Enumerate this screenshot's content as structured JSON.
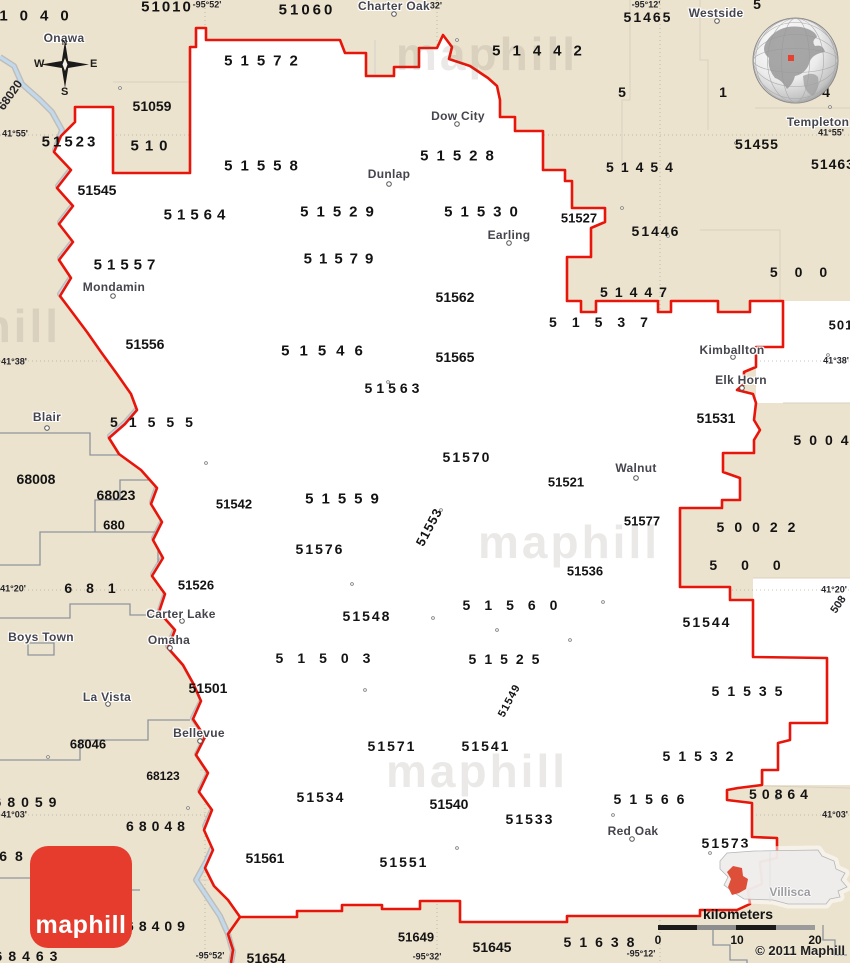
{
  "page": {
    "copyright": "© 2011 Maphill"
  },
  "logo": {
    "label": "maphill"
  },
  "compass": {
    "north": "N",
    "west": "W",
    "east": "E",
    "south": "S"
  },
  "scale_bar": {
    "title": "kilometers",
    "ticks": [
      "0",
      "10",
      "20"
    ]
  },
  "inset": {
    "label": "Villisca"
  },
  "map_colors": {
    "land": "#ece3cf",
    "region": "#ffffff",
    "boundary_red": "#e8150a",
    "river": "#bdd5ea",
    "logo_red": "#e53c2e",
    "inset_highlight": "#dd4f38"
  },
  "labels": {
    "zip_codes": [
      {
        "t": "1040",
        "x": 40,
        "y": 16,
        "s": 15,
        "w": 12
      },
      {
        "t": "51010",
        "x": 167,
        "y": 7,
        "s": 15,
        "w": 2
      },
      {
        "t": "51060",
        "x": 307,
        "y": 10,
        "s": 15,
        "w": 3
      },
      {
        "t": "51572",
        "x": 265,
        "y": 61,
        "s": 15,
        "w": 8
      },
      {
        "t": "51442",
        "x": 543,
        "y": 51,
        "s": 15,
        "w": 12
      },
      {
        "t": "51465",
        "x": 648,
        "y": 17,
        "s": 14,
        "w": 2
      },
      {
        "t": "5",
        "x": 757,
        "y": 4,
        "s": 14
      },
      {
        "t": "5",
        "x": 622,
        "y": 92,
        "s": 14
      },
      {
        "t": "1",
        "x": 723,
        "y": 92,
        "s": 14
      },
      {
        "t": "4",
        "x": 826,
        "y": 92,
        "s": 14
      },
      {
        "t": "51523",
        "x": 70,
        "y": 142,
        "s": 15,
        "w": 3
      },
      {
        "t": "51059",
        "x": 152,
        "y": 106,
        "s": 14
      },
      {
        "t": "510",
        "x": 152,
        "y": 146,
        "s": 15,
        "w": 6
      },
      {
        "t": "51545",
        "x": 97,
        "y": 190,
        "s": 14
      },
      {
        "t": "51558",
        "x": 265,
        "y": 166,
        "s": 15,
        "w": 8
      },
      {
        "t": "51528",
        "x": 461,
        "y": 156,
        "s": 15,
        "w": 8
      },
      {
        "t": "51454",
        "x": 643,
        "y": 167,
        "s": 14,
        "w": 7
      },
      {
        "t": "51455",
        "x": 757,
        "y": 144,
        "s": 14,
        "w": 1
      },
      {
        "t": "51463",
        "x": 833,
        "y": 164,
        "s": 14,
        "w": 1
      },
      {
        "t": "51564",
        "x": 197,
        "y": 215,
        "s": 15,
        "w": 5
      },
      {
        "t": "51529",
        "x": 341,
        "y": 212,
        "s": 15,
        "w": 8
      },
      {
        "t": "51530",
        "x": 485,
        "y": 212,
        "s": 15,
        "w": 8
      },
      {
        "t": "51527",
        "x": 579,
        "y": 218,
        "s": 13
      },
      {
        "t": "51446",
        "x": 656,
        "y": 231,
        "s": 14,
        "w": 2
      },
      {
        "t": "51557",
        "x": 127,
        "y": 265,
        "s": 15,
        "w": 5
      },
      {
        "t": "51579",
        "x": 342,
        "y": 259,
        "s": 15,
        "w": 7
      },
      {
        "t": "51562",
        "x": 455,
        "y": 297,
        "s": 14
      },
      {
        "t": "51447",
        "x": 637,
        "y": 292,
        "s": 14,
        "w": 7
      },
      {
        "t": "500",
        "x": 807,
        "y": 272,
        "s": 14,
        "w": 17
      },
      {
        "t": "51537",
        "x": 606,
        "y": 322,
        "s": 14,
        "w": 15
      },
      {
        "t": "501",
        "x": 841,
        "y": 325,
        "s": 13,
        "w": 1
      },
      {
        "t": "51556",
        "x": 145,
        "y": 344,
        "s": 14
      },
      {
        "t": "51546",
        "x": 327,
        "y": 351,
        "s": 15,
        "w": 10
      },
      {
        "t": "51565",
        "x": 455,
        "y": 357,
        "s": 14
      },
      {
        "t": "51563",
        "x": 394,
        "y": 388,
        "s": 14,
        "w": 4
      },
      {
        "t": "51555",
        "x": 157,
        "y": 422,
        "s": 14,
        "w": 11
      },
      {
        "t": "68008",
        "x": 36,
        "y": 479,
        "s": 14
      },
      {
        "t": "68023",
        "x": 116,
        "y": 495,
        "s": 14
      },
      {
        "t": "680",
        "x": 114,
        "y": 525,
        "s": 13
      },
      {
        "t": "51531",
        "x": 716,
        "y": 418,
        "s": 14
      },
      {
        "t": "5004",
        "x": 825,
        "y": 440,
        "s": 14,
        "w": 8
      },
      {
        "t": "51570",
        "x": 467,
        "y": 457,
        "s": 14,
        "w": 2
      },
      {
        "t": "51521",
        "x": 566,
        "y": 482,
        "s": 13
      },
      {
        "t": "51542",
        "x": 234,
        "y": 504,
        "s": 13
      },
      {
        "t": "51559",
        "x": 346,
        "y": 499,
        "s": 15,
        "w": 8
      },
      {
        "t": "51577",
        "x": 642,
        "y": 521,
        "s": 13
      },
      {
        "t": "50022",
        "x": 761,
        "y": 527,
        "s": 14,
        "w": 10
      },
      {
        "t": "51576",
        "x": 320,
        "y": 549,
        "s": 14,
        "w": 2
      },
      {
        "t": "500",
        "x": 757,
        "y": 565,
        "s": 14,
        "w": 24
      },
      {
        "t": "51536",
        "x": 585,
        "y": 571,
        "s": 13
      },
      {
        "t": "681",
        "x": 97,
        "y": 588,
        "s": 14,
        "w": 14
      },
      {
        "t": "51526",
        "x": 196,
        "y": 585,
        "s": 13
      },
      {
        "t": "51548",
        "x": 367,
        "y": 616,
        "s": 14,
        "w": 2
      },
      {
        "t": "51560",
        "x": 517,
        "y": 605,
        "s": 14,
        "w": 14
      },
      {
        "t": "51544",
        "x": 707,
        "y": 622,
        "s": 14,
        "w": 2
      },
      {
        "t": "51503",
        "x": 330,
        "y": 658,
        "s": 14,
        "w": 14
      },
      {
        "t": "51525",
        "x": 508,
        "y": 659,
        "s": 14,
        "w": 8
      },
      {
        "t": "51501",
        "x": 208,
        "y": 688,
        "s": 14
      },
      {
        "t": "51535",
        "x": 751,
        "y": 691,
        "s": 14,
        "w": 8
      },
      {
        "t": "68046",
        "x": 88,
        "y": 744,
        "s": 13
      },
      {
        "t": "51571",
        "x": 392,
        "y": 746,
        "s": 14,
        "w": 2
      },
      {
        "t": "51541",
        "x": 486,
        "y": 746,
        "s": 14,
        "w": 2
      },
      {
        "t": "51532",
        "x": 702,
        "y": 756,
        "s": 14,
        "w": 8
      },
      {
        "t": "68123",
        "x": 163,
        "y": 776,
        "s": 12
      },
      {
        "t": "68059",
        "x": 28,
        "y": 802,
        "s": 14,
        "w": 6
      },
      {
        "t": "68048",
        "x": 158,
        "y": 826,
        "s": 14,
        "w": 5
      },
      {
        "t": "50864",
        "x": 781,
        "y": 794,
        "s": 14,
        "w": 5
      },
      {
        "t": "51566",
        "x": 653,
        "y": 799,
        "s": 14,
        "w": 8
      },
      {
        "t": "51534",
        "x": 321,
        "y": 797,
        "s": 14,
        "w": 2
      },
      {
        "t": "51540",
        "x": 449,
        "y": 804,
        "s": 14
      },
      {
        "t": "51533",
        "x": 530,
        "y": 819,
        "s": 14,
        "w": 2
      },
      {
        "t": "51573",
        "x": 726,
        "y": 843,
        "s": 14,
        "w": 2
      },
      {
        "t": "51561",
        "x": 265,
        "y": 858,
        "s": 14
      },
      {
        "t": "68",
        "x": 15,
        "y": 856,
        "s": 14,
        "w": 8
      },
      {
        "t": "68409",
        "x": 158,
        "y": 926,
        "s": 14,
        "w": 5
      },
      {
        "t": "51551",
        "x": 404,
        "y": 862,
        "s": 14,
        "w": 2
      },
      {
        "t": "68463",
        "x": 29,
        "y": 956,
        "s": 14,
        "w": 6
      },
      {
        "t": "51649",
        "x": 416,
        "y": 937,
        "s": 13
      },
      {
        "t": "51645",
        "x": 492,
        "y": 947,
        "s": 14
      },
      {
        "t": "51638",
        "x": 603,
        "y": 942,
        "s": 14,
        "w": 8
      },
      {
        "t": "51654",
        "x": 266,
        "y": 958,
        "s": 14
      },
      {
        "t": "51553",
        "x": 429,
        "y": 527,
        "s": 13,
        "w": 1,
        "r": -62
      },
      {
        "t": "51549",
        "x": 510,
        "y": 701,
        "s": 11,
        "w": 1,
        "r": -62
      }
    ],
    "cities": [
      {
        "t": "Onawa",
        "x": 64,
        "y": 38
      },
      {
        "t": "Charter Oak",
        "x": 394,
        "y": 6
      },
      {
        "t": "Westside",
        "x": 716,
        "y": 13
      },
      {
        "t": "Templeton",
        "x": 818,
        "y": 122
      },
      {
        "t": "Dow City",
        "x": 458,
        "y": 116
      },
      {
        "t": "Dunlap",
        "x": 389,
        "y": 174
      },
      {
        "t": "Earling",
        "x": 509,
        "y": 235
      },
      {
        "t": "Mondamin",
        "x": 114,
        "y": 287
      },
      {
        "t": "Kimballton",
        "x": 732,
        "y": 350
      },
      {
        "t": "Elk Horn",
        "x": 741,
        "y": 380
      },
      {
        "t": "Blair",
        "x": 47,
        "y": 417
      },
      {
        "t": "Walnut",
        "x": 636,
        "y": 468
      },
      {
        "t": "Carter Lake",
        "x": 181,
        "y": 614
      },
      {
        "t": "Omaha",
        "x": 169,
        "y": 640
      },
      {
        "t": "Boys Town",
        "x": 41,
        "y": 637
      },
      {
        "t": "La Vista",
        "x": 107,
        "y": 697
      },
      {
        "t": "Bellevue",
        "x": 199,
        "y": 733
      },
      {
        "t": "Red Oak",
        "x": 633,
        "y": 831
      }
    ],
    "coordinates": [
      {
        "t": "-95°52'",
        "x": 207,
        "y": 5
      },
      {
        "t": "32'",
        "x": 436,
        "y": 6
      },
      {
        "t": "-95°12'",
        "x": 646,
        "y": 5
      },
      {
        "t": "41°55'",
        "x": 15,
        "y": 134
      },
      {
        "t": "41°55'",
        "x": 831,
        "y": 133
      },
      {
        "t": "41°38'",
        "x": 14,
        "y": 362
      },
      {
        "t": "41°38'",
        "x": 836,
        "y": 361
      },
      {
        "t": "41°20'",
        "x": 13,
        "y": 589
      },
      {
        "t": "41°20'",
        "x": 834,
        "y": 590
      },
      {
        "t": "41°03'",
        "x": 14,
        "y": 815
      },
      {
        "t": "41°03'",
        "x": 835,
        "y": 815
      },
      {
        "t": "-95°52'",
        "x": 210,
        "y": 956
      },
      {
        "t": "-95°32'",
        "x": 427,
        "y": 957
      },
      {
        "t": "-95°12'",
        "x": 641,
        "y": 954
      },
      {
        "t": "68020",
        "x": 10,
        "y": 95,
        "s": 12,
        "r": -55
      },
      {
        "t": "508",
        "x": 839,
        "y": 605,
        "s": 11,
        "r": -55
      }
    ],
    "watermarks": [
      {
        "t": "maphill",
        "x": 487,
        "y": 54
      },
      {
        "t": "maphill",
        "x": 569,
        "y": 542
      },
      {
        "t": "maphill",
        "x": 477,
        "y": 771
      },
      {
        "t": "maphill",
        "x": -30,
        "y": 326
      }
    ]
  }
}
